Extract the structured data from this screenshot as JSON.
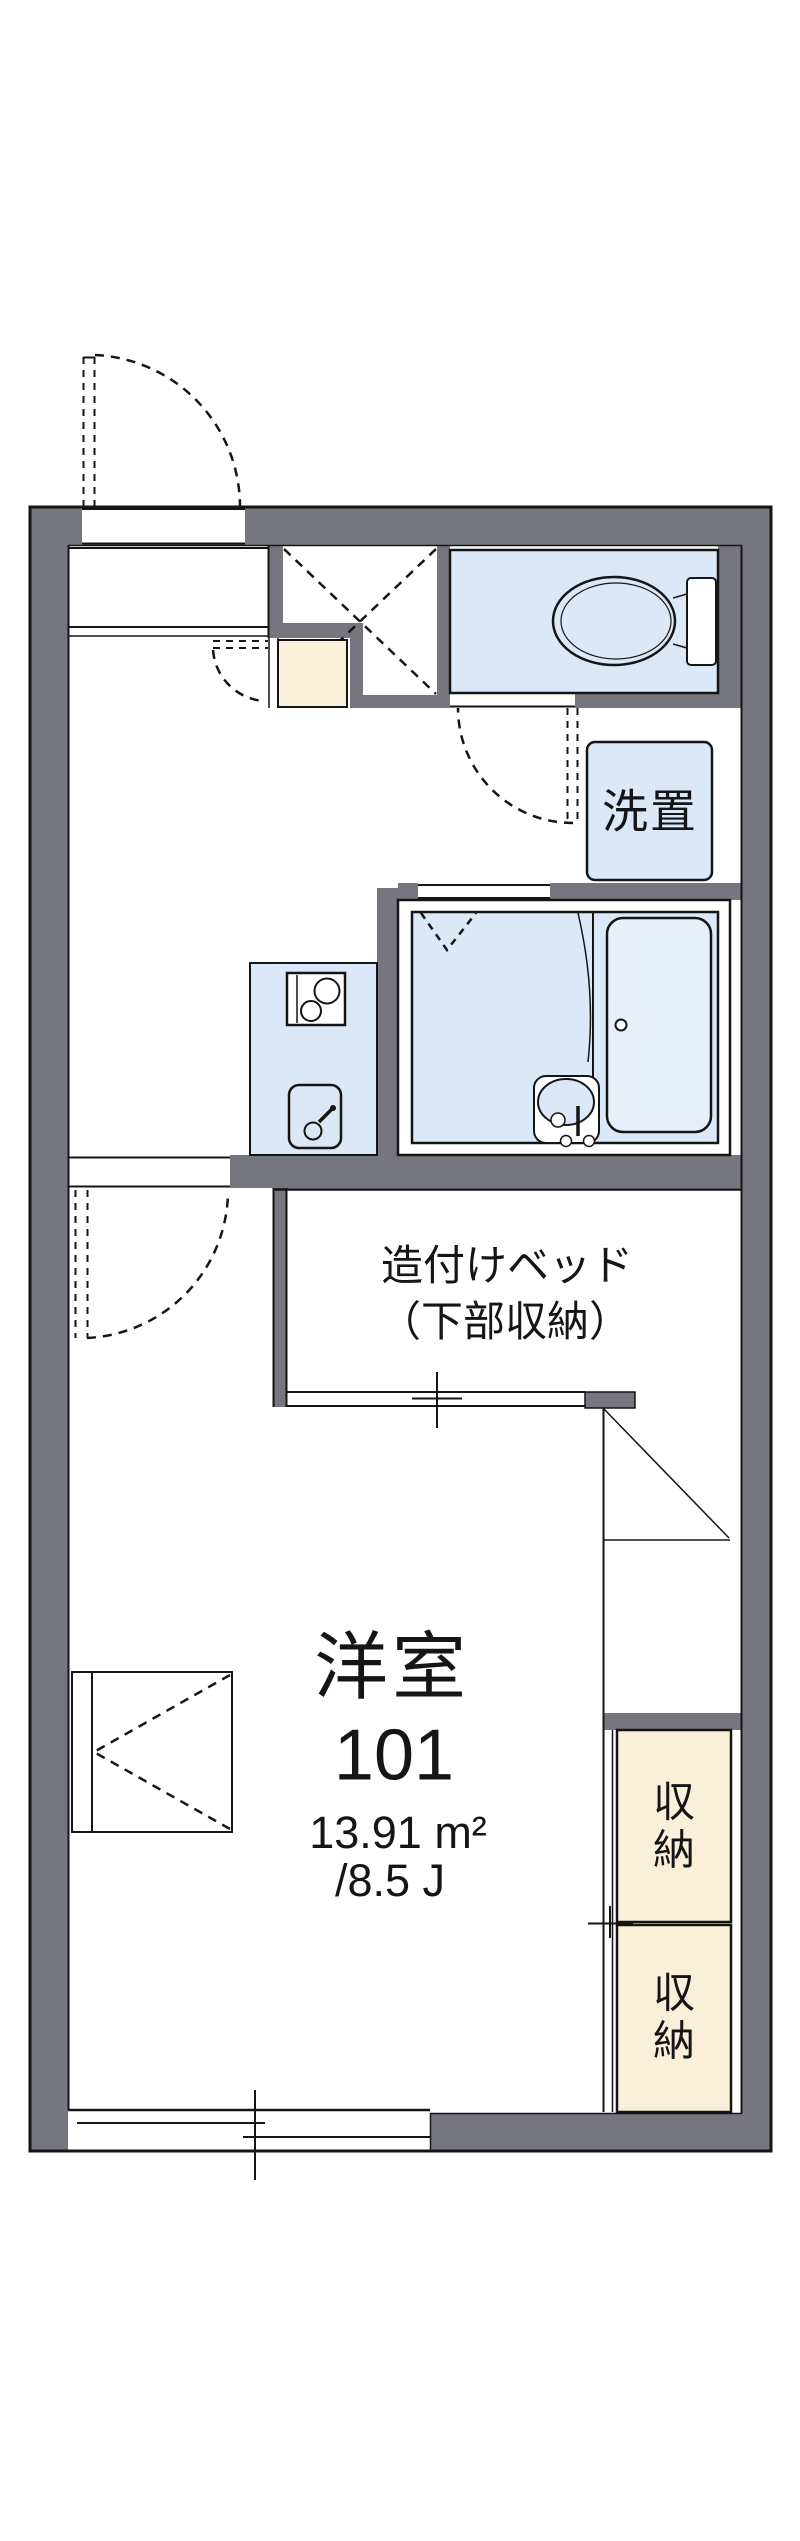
{
  "colors": {
    "wall_gray": "#76767e",
    "room_blue": "#dbe8f7",
    "tub_blue": "#e6effa",
    "storage_cream": "#faf0da",
    "line": "#151515"
  },
  "rooms": {
    "washer_label": "洗置",
    "bed_label_line1": "造付けベッド",
    "bed_label_line2": "（下部収納）",
    "main_room_name": "洋室",
    "main_room_number": "101",
    "main_room_area": "13.91 m²",
    "main_room_tatami": "/8.5 J",
    "storage1_label": "収納",
    "storage2_label": "収納"
  }
}
